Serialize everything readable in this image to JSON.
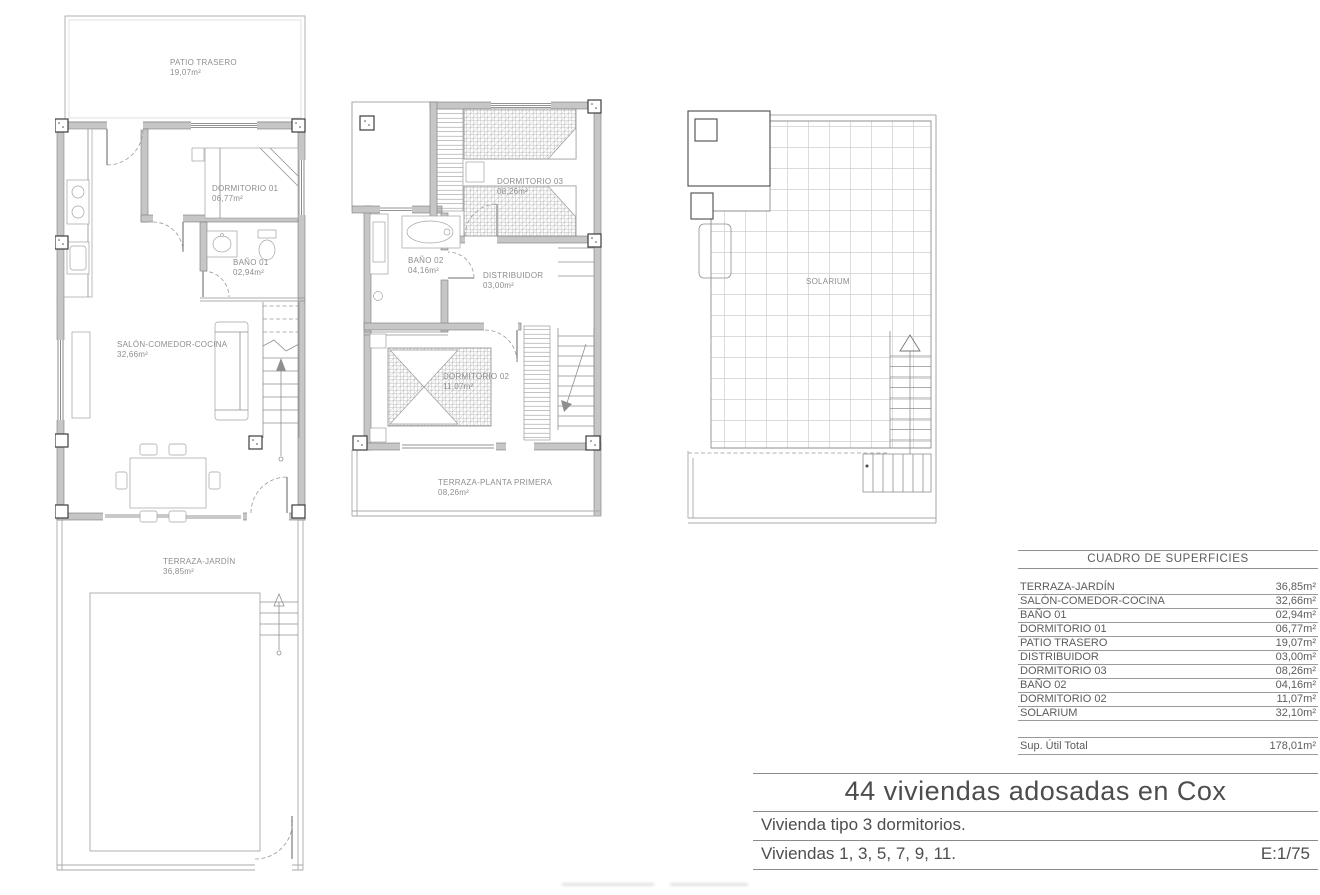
{
  "plans": {
    "ground": {
      "rooms": [
        {
          "name": "PATIO TRASERO",
          "area": "19,07m²"
        },
        {
          "name": "DORMITORIO 01",
          "area": "06,77m²"
        },
        {
          "name": "BAÑO 01",
          "area": "02,94m²"
        },
        {
          "name": "SALÓN-COMEDOR-COCINA",
          "area": "32,66m²"
        },
        {
          "name": "TERRAZA-JARDÍN",
          "area": "36,85m²"
        }
      ]
    },
    "first": {
      "rooms": [
        {
          "name": "DORMITORIO 03",
          "area": "08,26m²"
        },
        {
          "name": "BAÑO 02",
          "area": "04,16m²"
        },
        {
          "name": "DISTRIBUIDOR",
          "area": "03,00m²"
        },
        {
          "name": "DORMITORIO 02",
          "area": "11,07m²"
        },
        {
          "name": "TERRAZA-PLANTA PRIMERA",
          "area": "08,26m²"
        }
      ]
    },
    "roof": {
      "rooms": [
        {
          "name": "SOLARIUM",
          "area": ""
        }
      ]
    }
  },
  "surfaces_table": {
    "title": "CUADRO DE SUPERFICIES",
    "rows": [
      {
        "label": "TERRAZA-JARDÍN",
        "value": "36,85m²"
      },
      {
        "label": "SALÓN-COMEDOR-COCINA",
        "value": "32,66m²"
      },
      {
        "label": "BAÑO 01",
        "value": "02,94m²"
      },
      {
        "label": "DORMITORIO 01",
        "value": "06,77m²"
      },
      {
        "label": "PATIO TRASERO",
        "value": "19,07m²"
      },
      {
        "label": "DISTRIBUIDOR",
        "value": "03,00m²"
      },
      {
        "label": "DORMITORIO 03",
        "value": "08,26m²"
      },
      {
        "label": "BAÑO 02",
        "value": "04,16m²"
      },
      {
        "label": "DORMITORIO 02",
        "value": "11,07m²"
      },
      {
        "label": "SOLARIUM",
        "value": "32,10m²"
      }
    ],
    "total": {
      "label": "Sup. Útil Total",
      "value": "178,01m²"
    }
  },
  "title_block": {
    "project": "44 viviendas adosadas en Cox",
    "subtitle": "Vivienda tipo 3 dormitorios.",
    "units": "Viviendas 1, 3, 5, 7, 9, 11.",
    "scale": "E:1/75"
  }
}
